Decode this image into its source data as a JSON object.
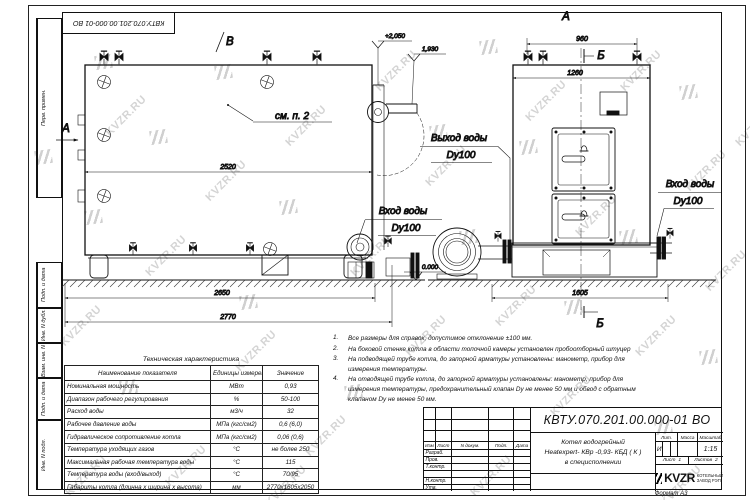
{
  "watermark": {
    "text": "KVZR.RU"
  },
  "corner_stamp": {
    "doc_number": "КВТУ.070.201.00.000-01 ВО"
  },
  "margin_labels": {
    "perv": "Перв. примен.",
    "podp1": "Подп. и дата",
    "inv_dubl": "Инв. N дубл.",
    "vzam": "Взам. инв. N",
    "podp2": "Подп. и дата",
    "inv_podl": "Инв. N подл."
  },
  "side_view": {
    "marker_v": "В",
    "marker_a": "А",
    "see_note": "см. п. 2",
    "dim_inner": "2520",
    "dim_base": "2650",
    "dim_overall": "2770",
    "elev_top": "+2,050",
    "elev_outlet": "1,930",
    "elev_ground": "0.000",
    "inlet_line1": "Вход воды",
    "inlet_line2": "Dy100"
  },
  "front_view": {
    "marker_a": "А",
    "marker_b": "Б",
    "dim_top": "960",
    "dim_body": "1260",
    "dim_base": "1605",
    "outlet_line1": "Выход воды",
    "outlet_line2": "Dy100",
    "inlet_line1": "Вход воды",
    "inlet_line2": "Dy100"
  },
  "tech_table": {
    "title": "Техническая характеристика",
    "headers": [
      "Наименование показателя",
      "Единицы измерения",
      "Значение"
    ],
    "rows": [
      {
        "name": "Номинальная мощность",
        "unit": "МВт",
        "value": "0,93"
      },
      {
        "name": "Диапазон рабочего регулирования",
        "unit": "%",
        "value": "50-100"
      },
      {
        "name": "Расход воды",
        "unit": "м3/ч",
        "value": "32"
      },
      {
        "name": "Рабочее давление воды",
        "unit": "МПа (кгс/см2)",
        "value": "0,6 (6,0)"
      },
      {
        "name": "Гидравлическое сопротивление котла",
        "unit": "МПа (кгс/см2)",
        "value": "0,06 (0,6)"
      },
      {
        "name": "Температура уходящих газов",
        "unit": "°С",
        "value": "не более 250"
      },
      {
        "name": "Максимальная рабочая температура воды",
        "unit": "°С",
        "value": "115"
      },
      {
        "name": "Температура воды (вход/выход)",
        "unit": "°С",
        "value": "70/95"
      },
      {
        "name": "Габариты котла (длинна х ширина х высота)",
        "unit": "мм",
        "value": "2770х1605х2050"
      }
    ]
  },
  "notes": [
    {
      "num": "1.",
      "text": "Все размеры для справок, допустимое отклонение ±100 мм."
    },
    {
      "num": "2.",
      "text": "На боковой стенке котла в области топочной камеры установлен пробоотборный штуцер"
    },
    {
      "num": "3.",
      "text": "На подводящей трубе котла, до запорной арматуры установлены: манометр, прибор для измерения температуры."
    },
    {
      "num": "4.",
      "text": "На отводящей трубе котла, до запорной арматуры установлены: манометр, прибор для измерения температуры, предохранительный клапан Dу не менее 50 мм и обвод с обратным клапаном Dу не менее 50 мм."
    }
  ],
  "title_block": {
    "doc_number": "КВТУ.070.201.00.000-01 ВО",
    "col_headers": [
      "Изм",
      "Лист",
      "N докум.",
      "Подп.",
      "Дата"
    ],
    "row_labels": [
      "Разраб.",
      "Пров.",
      "Т.контр.",
      "",
      "Н.контр.",
      "Утв."
    ],
    "product_line1": "Котел водогрейный",
    "product_line2": "Heatexpert- КВр -0,93- КБД ( К )",
    "product_line3": "в специсполнении",
    "lit_header": "Лит.",
    "mass_header": "Масса",
    "scale_header": "Масштаб",
    "lit_value": "И",
    "scale_value": "1:15",
    "sheet_label": "Лист",
    "sheet_value": "1",
    "sheets_label": "Листов",
    "sheets_value": "2",
    "logo_text": "KVZR",
    "company_line1": "КОТЕЛЬНЫЙ",
    "company_line2": "ЗАВОД РЭП",
    "format_label": "Формат",
    "format_value": "А3"
  }
}
